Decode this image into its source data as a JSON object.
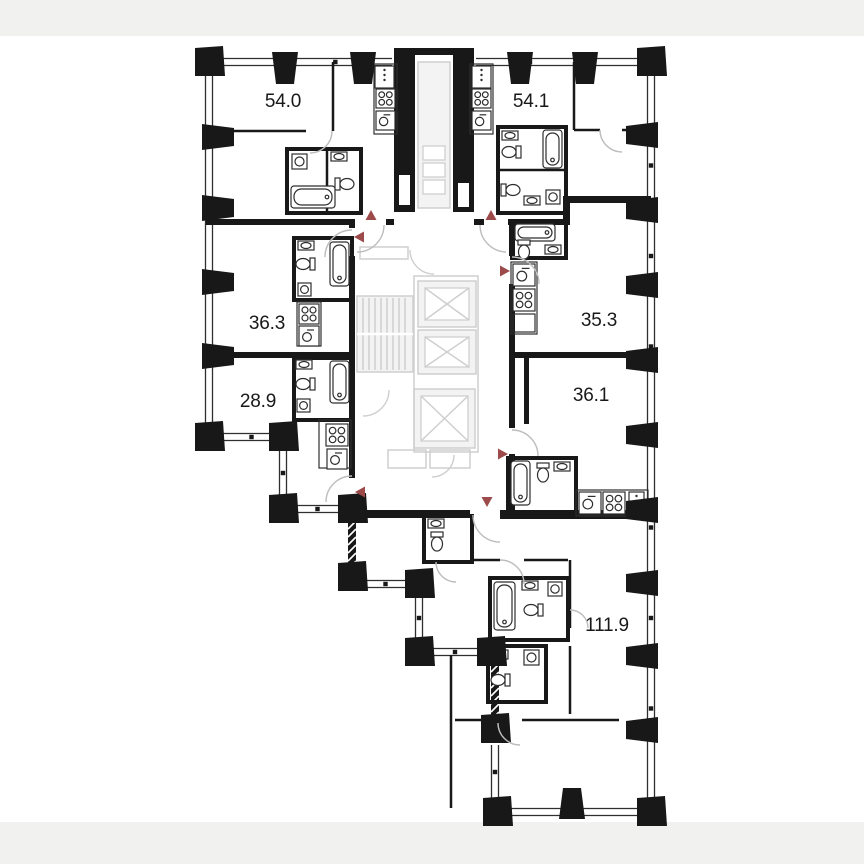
{
  "page": {
    "background": "#ffffff",
    "frame_strip_color": "#f1f1ef"
  },
  "palette": {
    "wall": "#181818",
    "window_line": "#2f2f2f",
    "core_line": "#cfcfcf",
    "core_fill": "#f3f3f3",
    "door_arc": "#bdbdbd",
    "fixture_line": "#2e2e2e",
    "entry_marker": "#9c4a4a",
    "label_text": "#191919"
  },
  "floor_plan": {
    "kind": "residential floor plan",
    "units": [
      {
        "label": "54.0"
      },
      {
        "label": "54.1"
      },
      {
        "label": "36.3"
      },
      {
        "label": "35.3"
      },
      {
        "label": "28.9"
      },
      {
        "label": "36.1"
      },
      {
        "label": "111.9"
      }
    ]
  }
}
